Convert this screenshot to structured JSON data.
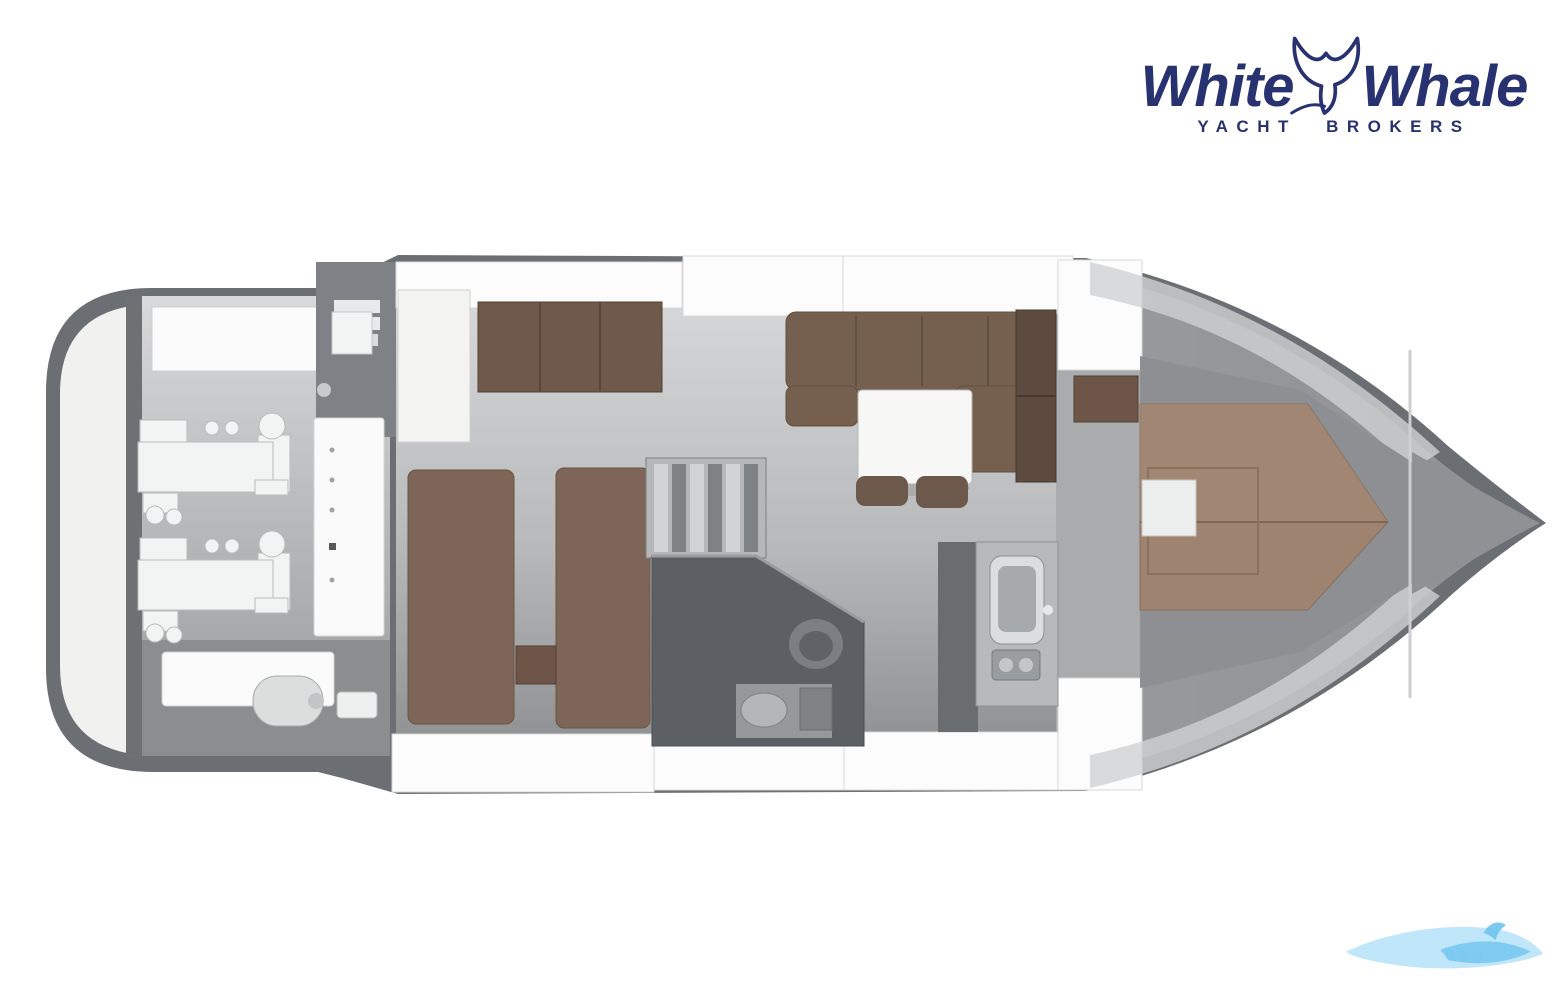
{
  "logo": {
    "word_left": "White",
    "word_right": "Whale",
    "subtitle": "YACHT BROKERS",
    "icon": "whale-tail-icon"
  },
  "palette": {
    "logo-navy": "#283271",
    "hull-dark": "#6b6e72",
    "deck-white": "#fcfcfc",
    "platform-light": "#f1f1f0",
    "floor-light": "#d6d7d8",
    "floor-dark": "#8f9193",
    "wood-brown": "#6e594b",
    "bed-brown": "#7d6557",
    "berth-brown": "#9d8370",
    "bath-dark": "#5c5f63",
    "watermark-blue-light": "#b5e2f9",
    "watermark-blue": "#6fc4ef"
  },
  "plan": {
    "type": "yacht-floor-plan-top-view",
    "areas": [
      {
        "id": "swim-platform"
      },
      {
        "id": "engine-room",
        "engines": 2,
        "items": [
          "stern-locker",
          "bulkhead-panel",
          "muffler-tank"
        ]
      },
      {
        "id": "twin-guest-cabin",
        "beds": 2,
        "items": [
          "wardrobe",
          "closet",
          "nightstand"
        ]
      },
      {
        "id": "staircase"
      },
      {
        "id": "bathroom",
        "items": [
          "toilet",
          "sink",
          "shower-unit"
        ]
      },
      {
        "id": "salon",
        "items": [
          "l-shaped-sofa",
          "table",
          "stool",
          "stool"
        ]
      },
      {
        "id": "galley",
        "items": [
          "sink",
          "stove",
          "cabinet"
        ]
      },
      {
        "id": "bow-cabin",
        "items": [
          "double-berth",
          "nightstand"
        ]
      },
      {
        "id": "bow-deck"
      }
    ]
  },
  "watermark": {
    "icon": "wave-whale-watermark"
  }
}
